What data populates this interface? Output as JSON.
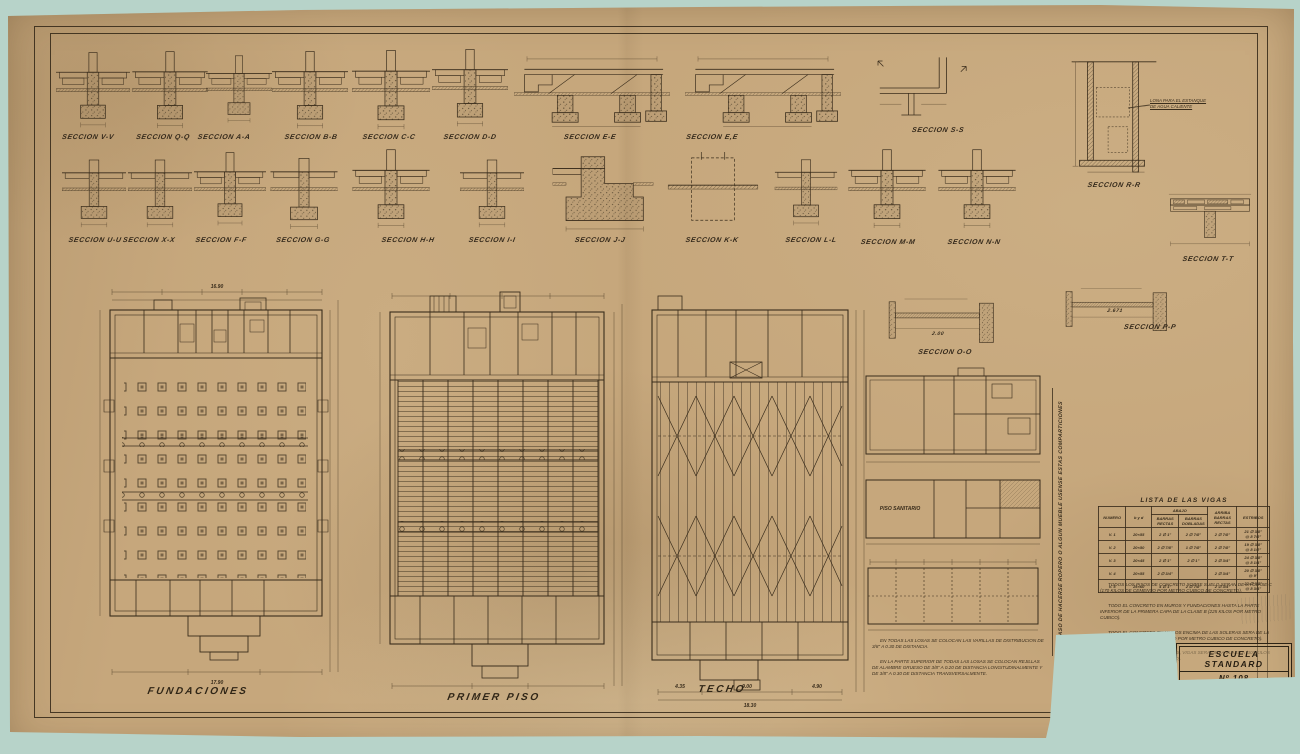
{
  "colors": {
    "background": "#b7d3c9",
    "paper": "#c6a77c",
    "ink": "#3a2d1c"
  },
  "sections_row1": [
    "SECCION V-V",
    "SECCION Q-Q",
    "SECCION A-A",
    "SECCION B-B",
    "SECCION C-C",
    "SECCION D-D",
    "SECCION E-E",
    "SECCION E,E",
    "SECCION S-S"
  ],
  "sections_row2": [
    "SECCION U-U",
    "SECCION X-X",
    "SECCION F-F",
    "SECCION G-G",
    "SECCION H-H",
    "SECCION I-I",
    "SECCION J-J",
    "SECCION K-K",
    "SECCION L-L",
    "SECCION M-M",
    "SECCION N-N"
  ],
  "sections_right": {
    "rr": "SECCION R-R",
    "tt": "SECCION T-T",
    "oo": "SECCION O-O",
    "pp": "SECCION P-P"
  },
  "plans": [
    "FUNDACIONES",
    "PRIMER PISO",
    "TECHO"
  ],
  "tank_note": "LONA PARA EL ESTANQUE\nDE AGUA CALIENTE",
  "side_note_vertical": "EN CASO DE HACERSE ROPERO O ALGUN MUEBLE USENSE ESTAS COMPARTICIONES",
  "small_plan_labels": {
    "sanitario": "PISO SANITARIO"
  },
  "dims": {
    "fund_top": "16.90",
    "fund_bottom": "17.90",
    "techo_seg1": "4.35",
    "techo_seg2": "9.00",
    "techo_seg3": "4.90",
    "techo_total": "18.30",
    "oo_span": "2.00",
    "pp_span": "2.671"
  },
  "beam_table": {
    "title": "LISTA DE LAS VIGAS",
    "headers": {
      "numero": "NUMERO",
      "byd": "b y d",
      "abajo": "ABAJO",
      "abajo_sub1": "BARRAS RECTAS",
      "abajo_sub2": "BARRAS DOBLADAS",
      "arriba": "ARRIBA\nBARRAS RECTAS",
      "estribos": "ESTRIBOS"
    },
    "rows": [
      [
        "V. 1",
        "20×55",
        "2 ∅ 1\"",
        "2 ∅ 7/8\"",
        "2 ∅ 7/8\"",
        "21 ∅ 3/8\"\n@ 8 7/8\""
      ],
      [
        "V. 2",
        "20×50",
        "2 ∅ 7/8\"",
        "1 ∅ 7/8\"",
        "2 ∅ 7/8\"",
        "19 ∅ 3/8\"\n@ 8 1/2\""
      ],
      [
        "V. 3",
        "20×45",
        "2 ∅ 1\"",
        "2 ∅ 1\"",
        "2 ∅ 3/4\"",
        "24 ∅ 3/8\"\n@ 8 1/4\""
      ],
      [
        "V. 4",
        "20×55",
        "2 ∅ 3/4\"",
        "",
        "2 ∅ 3/4\"",
        "20 ∅ 3/8\"\n@ 9\""
      ],
      [
        "V. 5",
        "25×60",
        "4 ∅ 1\"",
        "2 ∅ 7/8\"",
        "2 ∅ 3/4\"",
        "22 ∅ 3/8\"\n@ 8 3/4\""
      ]
    ]
  },
  "notes_right": [
    "TODOS LOS PISOS DE CONCRETO SOBRE SUELO SERAN DE LA CLASE C (170 KILOS DE CEMENTO POR METRO CUBICO DE CONCRETO).",
    "TODO EL CONCRETO EN MUROS Y FUNDACIONES HASTA LA PARTE INFERIOR DE LA PRIMERA CAPA DE LA CLASE B (225 KILOS POR METRO CUBICO).",
    "TODO EL CONCRETO EN MUROS ENCIMA DE LAS SOLERAS SERA DE LA CLASE B (250 KILOS DE CEMENTO POR METRO CUBICO DE CONCRETO).",
    "TODO EL CONCRETO EN LOSAS, VIGAS SERA DE LA CLASE A (300 KILOS DE CEMENTO POR METRO CUBICO)."
  ],
  "notes_bottom": [
    "EN TODAS LAS LOSAS SE COLOCAN LAS VARILLAS DE DISTRIBUCION DE 3/8\" A 0.30 DE DISTANCIA.",
    "EN LA PARTE SUPERIOR DE TODAS LAS LOSAS SE COLOCAN REJILLAS DE ALAMBRE GRUESO DE 3/8\" A 0.20 DE DISTANCIA LONGITUDINALMENTE Y DE 3/8\" A 0.30 DE DISTANCIA TRANSVERSALMENTE."
  ],
  "title_block": {
    "line1": "ESCUELA STANDARD",
    "line2": "Nº 108"
  }
}
